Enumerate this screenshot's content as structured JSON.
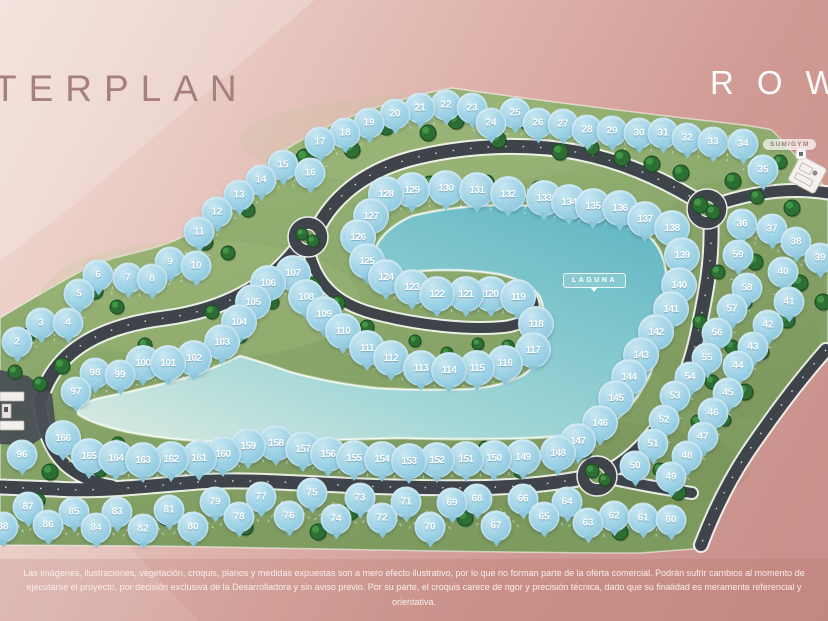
{
  "header": {
    "title": "TERPLAN",
    "brand": "ROW"
  },
  "map": {
    "laguna_label": "LAGUNA",
    "amenity_label": "SUM/GYM",
    "colors": {
      "background_light": "#f2ddd6",
      "background_dark": "#c98f8a",
      "grass": "#8aa76c",
      "road": "#3f444a",
      "lagoon_shallow": "#d8e9e0",
      "lagoon_deep": "#5cb4c2",
      "marker_blue": "#9ed2e6",
      "tree_green": "#2c6e33",
      "title_color": "#a5807e",
      "logo_color": "#ffffff"
    },
    "markers": [
      [
        2,
        17,
        342
      ],
      [
        3,
        41,
        323
      ],
      [
        4,
        68,
        323
      ],
      [
        5,
        79,
        294
      ],
      [
        6,
        98,
        275
      ],
      [
        7,
        128,
        278
      ],
      [
        8,
        152,
        279
      ],
      [
        9,
        170,
        262
      ],
      [
        10,
        196,
        266
      ],
      [
        11,
        199,
        232
      ],
      [
        12,
        217,
        212
      ],
      [
        13,
        239,
        195
      ],
      [
        14,
        261,
        180
      ],
      [
        15,
        283,
        165
      ],
      [
        16,
        310,
        173
      ],
      [
        17,
        320,
        142
      ],
      [
        18,
        345,
        133
      ],
      [
        19,
        369,
        123
      ],
      [
        20,
        395,
        114
      ],
      [
        21,
        420,
        108
      ],
      [
        22,
        446,
        105
      ],
      [
        23,
        472,
        108
      ],
      [
        24,
        491,
        123
      ],
      [
        25,
        515,
        113
      ],
      [
        26,
        538,
        123
      ],
      [
        27,
        563,
        124
      ],
      [
        28,
        587,
        130
      ],
      [
        29,
        612,
        131
      ],
      [
        30,
        639,
        133
      ],
      [
        31,
        663,
        133
      ],
      [
        32,
        687,
        138
      ],
      [
        33,
        713,
        142
      ],
      [
        34,
        743,
        144
      ],
      [
        35,
        763,
        170
      ],
      [
        36,
        742,
        224
      ],
      [
        37,
        772,
        229
      ],
      [
        38,
        796,
        242
      ],
      [
        39,
        820,
        258
      ],
      [
        40,
        783,
        272
      ],
      [
        41,
        789,
        302
      ],
      [
        42,
        768,
        325
      ],
      [
        43,
        753,
        347
      ],
      [
        44,
        738,
        366
      ],
      [
        45,
        728,
        393
      ],
      [
        46,
        713,
        413
      ],
      [
        47,
        703,
        437
      ],
      [
        48,
        687,
        456
      ],
      [
        49,
        671,
        477
      ],
      [
        50,
        635,
        466
      ],
      [
        51,
        653,
        444
      ],
      [
        52,
        664,
        420
      ],
      [
        53,
        675,
        396
      ],
      [
        54,
        690,
        377
      ],
      [
        55,
        707,
        358
      ],
      [
        56,
        717,
        333
      ],
      [
        57,
        732,
        309
      ],
      [
        58,
        747,
        288
      ],
      [
        59,
        738,
        255
      ],
      [
        60,
        671,
        520
      ],
      [
        61,
        643,
        518
      ],
      [
        62,
        614,
        516
      ],
      [
        63,
        588,
        523
      ],
      [
        64,
        567,
        502
      ],
      [
        65,
        544,
        517
      ],
      [
        66,
        523,
        499
      ],
      [
        67,
        496,
        526
      ],
      [
        68,
        477,
        499
      ],
      [
        69,
        452,
        503
      ],
      [
        70,
        430,
        527
      ],
      [
        71,
        406,
        502
      ],
      [
        72,
        382,
        518
      ],
      [
        73,
        360,
        498
      ],
      [
        74,
        336,
        519
      ],
      [
        75,
        312,
        493
      ],
      [
        76,
        289,
        516
      ],
      [
        77,
        261,
        497
      ],
      [
        78,
        239,
        517
      ],
      [
        79,
        215,
        502
      ],
      [
        80,
        193,
        527
      ],
      [
        81,
        169,
        510
      ],
      [
        82,
        143,
        529
      ],
      [
        83,
        117,
        512
      ],
      [
        84,
        96,
        528
      ],
      [
        85,
        74,
        512
      ],
      [
        86,
        48,
        525
      ],
      [
        87,
        28,
        507
      ],
      [
        88,
        3,
        527
      ],
      [
        96,
        22,
        455
      ],
      [
        97,
        76,
        392
      ],
      [
        98,
        95,
        373
      ],
      [
        99,
        120,
        375
      ],
      [
        100,
        143,
        363
      ],
      [
        101,
        168,
        363
      ],
      [
        102,
        194,
        358
      ],
      [
        103,
        222,
        342
      ],
      [
        104,
        239,
        322
      ],
      [
        105,
        253,
        302
      ],
      [
        106,
        268,
        283
      ],
      [
        107,
        293,
        273
      ],
      [
        108,
        306,
        297
      ],
      [
        109,
        324,
        314
      ],
      [
        110,
        343,
        331
      ],
      [
        111,
        367,
        348
      ],
      [
        112,
        391,
        358
      ],
      [
        113,
        421,
        368
      ],
      [
        114,
        449,
        370
      ],
      [
        115,
        477,
        368
      ],
      [
        116,
        505,
        363
      ],
      [
        117,
        533,
        350
      ],
      [
        118,
        536,
        324
      ],
      [
        119,
        518,
        297
      ],
      [
        120,
        491,
        294
      ],
      [
        121,
        466,
        294
      ],
      [
        122,
        437,
        294
      ],
      [
        123,
        412,
        287
      ],
      [
        124,
        386,
        277
      ],
      [
        125,
        367,
        261
      ],
      [
        126,
        358,
        237
      ],
      [
        127,
        371,
        216
      ],
      [
        128,
        386,
        194
      ],
      [
        129,
        412,
        190
      ],
      [
        130,
        446,
        188
      ],
      [
        131,
        477,
        190
      ],
      [
        132,
        508,
        194
      ],
      [
        133,
        544,
        198
      ],
      [
        134,
        569,
        202
      ],
      [
        135,
        593,
        206
      ],
      [
        136,
        620,
        208
      ],
      [
        137,
        645,
        219
      ],
      [
        138,
        672,
        228
      ],
      [
        139,
        682,
        255
      ],
      [
        140,
        679,
        285
      ],
      [
        141,
        671,
        309
      ],
      [
        142,
        656,
        332
      ],
      [
        143,
        641,
        355
      ],
      [
        144,
        629,
        377
      ],
      [
        145,
        616,
        398
      ],
      [
        146,
        600,
        423
      ],
      [
        147,
        578,
        441
      ],
      [
        148,
        558,
        453
      ],
      [
        149,
        523,
        457
      ],
      [
        150,
        494,
        458
      ],
      [
        151,
        466,
        459
      ],
      [
        152,
        437,
        460
      ],
      [
        153,
        409,
        461
      ],
      [
        154,
        382,
        459
      ],
      [
        155,
        354,
        458
      ],
      [
        156,
        328,
        454
      ],
      [
        157,
        303,
        449
      ],
      [
        158,
        276,
        443
      ],
      [
        159,
        248,
        446
      ],
      [
        160,
        223,
        454
      ],
      [
        161,
        199,
        458
      ],
      [
        162,
        171,
        459
      ],
      [
        163,
        143,
        460
      ],
      [
        164,
        116,
        458
      ],
      [
        165,
        89,
        456
      ],
      [
        166,
        63,
        438
      ]
    ],
    "tree_positions": [
      [
        305,
        158,
        9
      ],
      [
        352,
        150,
        8
      ],
      [
        386,
        127,
        8
      ],
      [
        428,
        133,
        8
      ],
      [
        456,
        121,
        8
      ],
      [
        498,
        140,
        8
      ],
      [
        527,
        123,
        7
      ],
      [
        560,
        152,
        8
      ],
      [
        592,
        148,
        7
      ],
      [
        622,
        158,
        8
      ],
      [
        652,
        164,
        8
      ],
      [
        681,
        173,
        8
      ],
      [
        733,
        181,
        8
      ],
      [
        757,
        197,
        7
      ],
      [
        700,
        205,
        8
      ],
      [
        713,
        212,
        7
      ],
      [
        302,
        234,
        6
      ],
      [
        313,
        241,
        6
      ],
      [
        592,
        471,
        7
      ],
      [
        605,
        480,
        6
      ],
      [
        205,
        242,
        8
      ],
      [
        228,
        253,
        7
      ],
      [
        248,
        210,
        7
      ],
      [
        95,
        291,
        8
      ],
      [
        117,
        307,
        7
      ],
      [
        48,
        322,
        8
      ],
      [
        28,
        335,
        7
      ],
      [
        62,
        366,
        8
      ],
      [
        40,
        384,
        7
      ],
      [
        15,
        372,
        7
      ],
      [
        145,
        345,
        7
      ],
      [
        212,
        312,
        7
      ],
      [
        240,
        336,
        7
      ],
      [
        272,
        302,
        7
      ],
      [
        282,
        273,
        6
      ],
      [
        312,
        284,
        7
      ],
      [
        338,
        303,
        7
      ],
      [
        367,
        327,
        7
      ],
      [
        415,
        341,
        6
      ],
      [
        447,
        353,
        6
      ],
      [
        478,
        344,
        6
      ],
      [
        508,
        346,
        6
      ],
      [
        430,
        183,
        7
      ],
      [
        487,
        182,
        7
      ],
      [
        538,
        187,
        6
      ],
      [
        690,
        252,
        7
      ],
      [
        718,
        272,
        7
      ],
      [
        755,
        262,
        8
      ],
      [
        800,
        283,
        8
      ],
      [
        745,
        302,
        7
      ],
      [
        787,
        320,
        8
      ],
      [
        700,
        322,
        7
      ],
      [
        732,
        347,
        7
      ],
      [
        762,
        352,
        7
      ],
      [
        712,
        382,
        7
      ],
      [
        745,
        392,
        8
      ],
      [
        698,
        422,
        7
      ],
      [
        725,
        420,
        6
      ],
      [
        660,
        470,
        7
      ],
      [
        780,
        162,
        7
      ],
      [
        792,
        208,
        8
      ],
      [
        823,
        302,
        8
      ],
      [
        748,
        228,
        7
      ],
      [
        118,
        444,
        7
      ],
      [
        50,
        472,
        8
      ],
      [
        100,
        470,
        7
      ],
      [
        38,
        500,
        7
      ],
      [
        165,
        518,
        7
      ],
      [
        245,
        527,
        8
      ],
      [
        318,
        532,
        8
      ],
      [
        350,
        512,
        8
      ],
      [
        430,
        470,
        6
      ],
      [
        465,
        518,
        8
      ],
      [
        485,
        447,
        6
      ],
      [
        520,
        472,
        6
      ],
      [
        560,
        500,
        7
      ],
      [
        620,
        532,
        8
      ],
      [
        678,
        492,
        8
      ],
      [
        585,
        452,
        6
      ]
    ]
  },
  "footer": {
    "disclaimer": "Las imágenes, ilustraciones, vegetación, croquis, planos y medidas expuestas son a mero efecto ilustrativo, por lo que no forman parte de la oferta comercial. Podrán sufrir cambios al momento de ejecutarse el proyecto, por decisión exclusiva de la Desarrolladora y sin aviso previo. Por su parte, el croquis carece de rigor y precisión técnica, dado que su finalidad es meramente referencial y orientativa."
  }
}
